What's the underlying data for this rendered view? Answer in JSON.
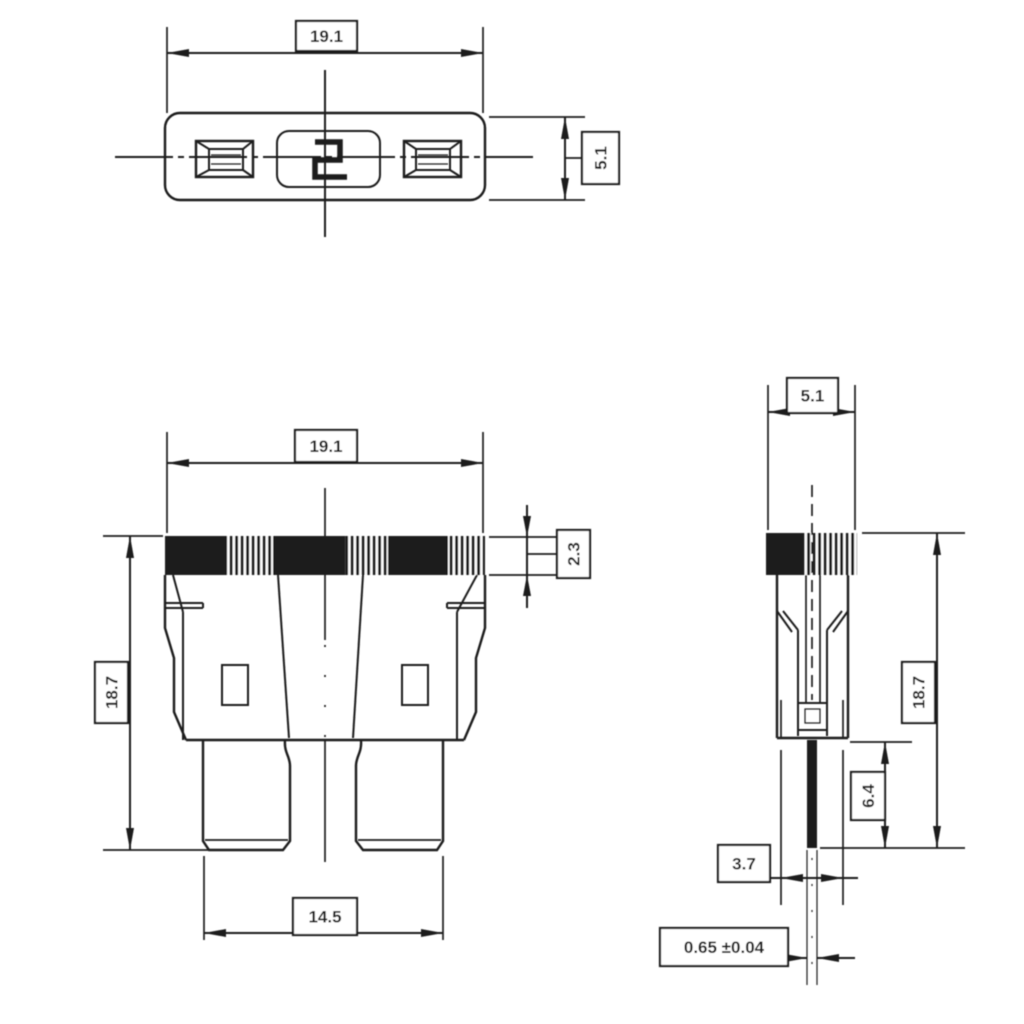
{
  "colors": {
    "background": "#ffffff",
    "ink": "#1c1c1c"
  },
  "dimensions": {
    "top_view": {
      "width": "19.1",
      "height": "5.1"
    },
    "front_view": {
      "width": "19.1",
      "overall_height": "18.7",
      "cap_band_height": "2.3",
      "blade_span": "14.5"
    },
    "side_view": {
      "width": "5.1",
      "overall_height": "18.7",
      "blade_length": "6.4",
      "lower_body_width": "3.7",
      "blade_thickness": "0.65 ±0.04"
    }
  }
}
